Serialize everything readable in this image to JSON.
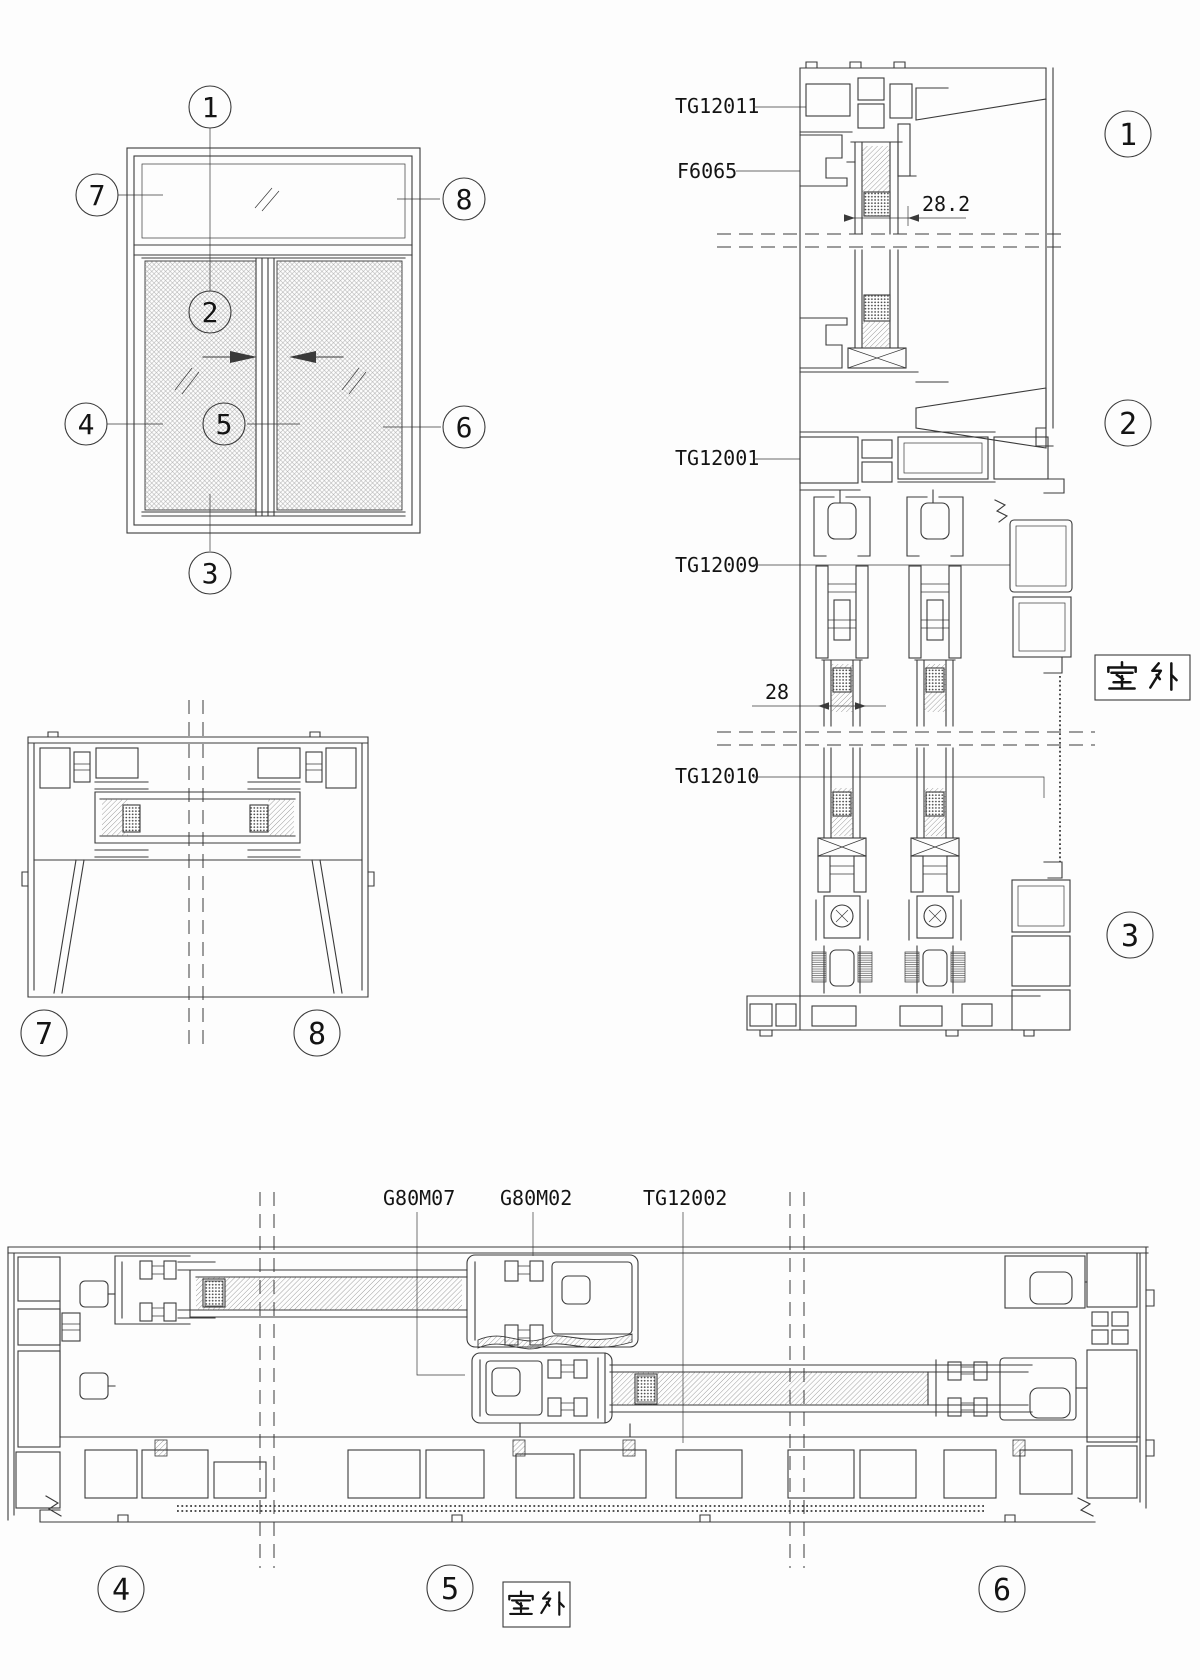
{
  "page": {
    "colors": {
      "line": "#3a3a3a",
      "text": "#141414",
      "bg": "#fdfdfd",
      "hatch": "#777777",
      "mesh": "#b0b0b0"
    }
  },
  "elevation": {
    "markers": [
      {
        "label": "1"
      },
      {
        "label": "2"
      },
      {
        "label": "3"
      },
      {
        "label": "4"
      },
      {
        "label": "5"
      },
      {
        "label": "6"
      },
      {
        "label": "7"
      },
      {
        "label": "8"
      }
    ]
  },
  "vertical_section": {
    "part_labels": [
      {
        "text": "TG12011"
      },
      {
        "text": "F6065"
      },
      {
        "text": "TG12001"
      },
      {
        "text": "TG12009"
      },
      {
        "text": "TG12010"
      }
    ],
    "dimensions": [
      {
        "text": "28.2"
      },
      {
        "text": "28"
      }
    ],
    "outdoor": {
      "text": "室 外"
    },
    "markers": [
      {
        "label": "1"
      },
      {
        "label": "2"
      },
      {
        "label": "3"
      }
    ]
  },
  "jamb_section": {
    "markers": [
      {
        "label": "7"
      },
      {
        "label": "8"
      }
    ]
  },
  "plan_section": {
    "part_labels": [
      {
        "text": "G80M07"
      },
      {
        "text": "G80M02"
      },
      {
        "text": "TG12002"
      }
    ],
    "outdoor": {
      "text": "室 外"
    },
    "markers": [
      {
        "label": "4"
      },
      {
        "label": "5"
      },
      {
        "label": "6"
      }
    ]
  }
}
